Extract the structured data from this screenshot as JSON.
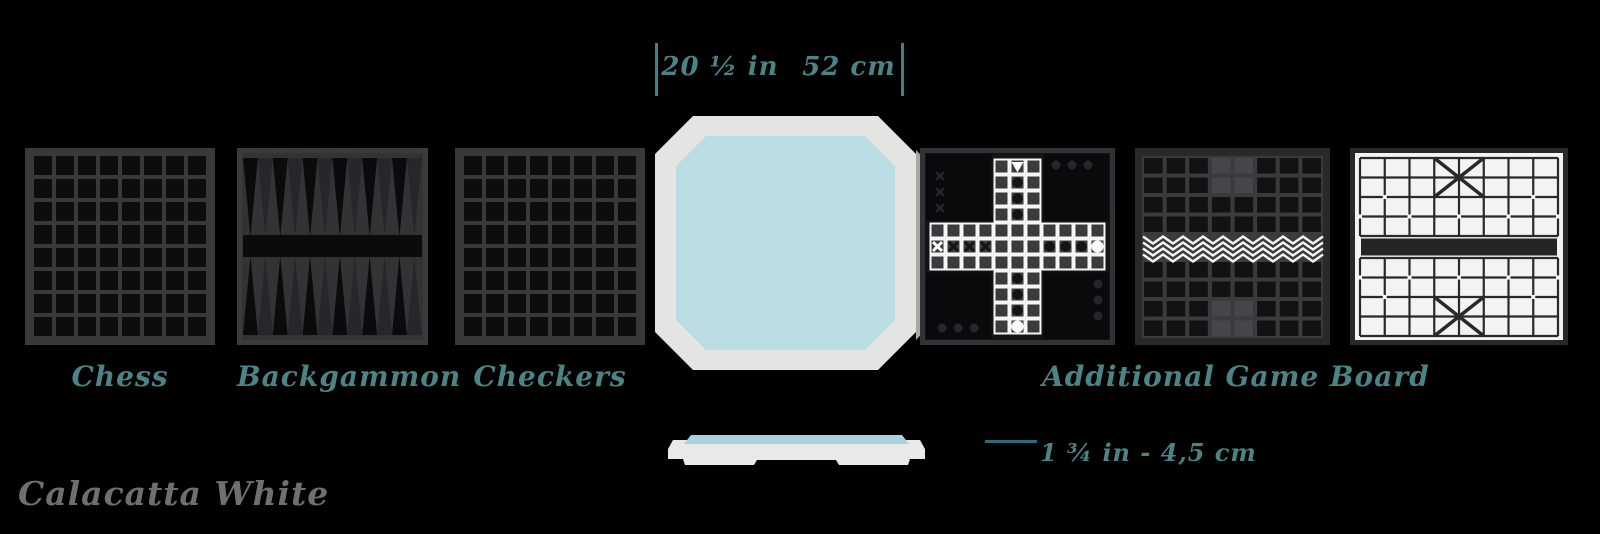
{
  "page": {
    "background": "#000000"
  },
  "colors": {
    "accent_teal": "#4a8487",
    "finish_text_gray": "#6f6f71",
    "board_cell_dark": "#0d0d0f",
    "board_grout_gray": "#38393b",
    "product_frame_white": "#e4e5e2",
    "product_surface_blue": "#b9dde2",
    "xiangqi_background": "#f3f3f1"
  },
  "width_dimension": {
    "inches": "20 ½ in",
    "centimeters": "52 cm"
  },
  "thickness_dimension": {
    "label": "1 ¾ in - 4,5 cm"
  },
  "board_labels": {
    "chess": "Chess",
    "backgammon": "Backgammon",
    "checkers": "Checkers",
    "additional": "Additional Game Board"
  },
  "finish": {
    "name": "Calacatta White"
  },
  "graphics": [
    "chess-board",
    "backgammon-board",
    "checkers-board",
    "product-top-view",
    "ludo-board",
    "xiangqi-dark-board",
    "xiangqi-board",
    "product-side-view"
  ]
}
